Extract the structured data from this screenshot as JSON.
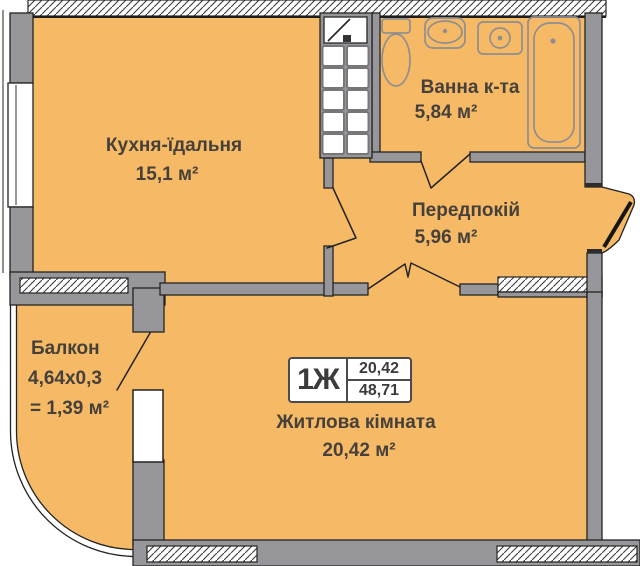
{
  "plan": {
    "rooms": [
      {
        "id": "kitchen",
        "name": "Кухня-їдальня",
        "area": "15,1 м²"
      },
      {
        "id": "bathroom",
        "name": "Ванна к-та",
        "area": "5,84 м²"
      },
      {
        "id": "hallway",
        "name": "Передпокій",
        "area": "5,96 м²"
      },
      {
        "id": "balcony",
        "name": "Балкон",
        "dimensions": "4,64х0,3",
        "area": "= 1,39 м²"
      },
      {
        "id": "living",
        "name": "Житлова кімната",
        "area": "20,42 м²"
      }
    ],
    "stamp": {
      "apartment_type": "1Ж",
      "living_area": "20,42",
      "total_area": "48,71"
    },
    "fixtures": [
      "toilet",
      "sink",
      "washing-machine",
      "bathtub",
      "ventilation-block"
    ],
    "colors": {
      "room_fill": "#f6ba67",
      "wall": "#97979b",
      "outline": "#232323",
      "fixture": "#8e8e91",
      "text": "#46403a",
      "stamp_border": "#4b4b4b",
      "hatch_line": "#3a3a3a"
    }
  }
}
